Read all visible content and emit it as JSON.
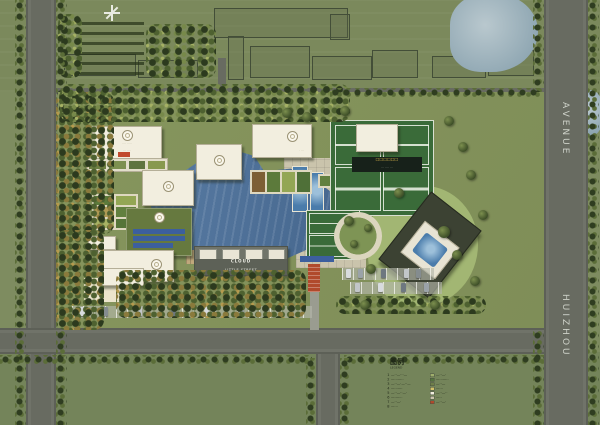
{
  "roads": {
    "avenue_top": "AVENUE",
    "avenue_bottom": "HUIZHOU"
  },
  "site": {
    "cloud_line1": "CLOUD",
    "cloud_line2": "LITTLE STREET",
    "court_line1": "□□□□□□",
    "court_line2": "··· ···· ···",
    "bldg_a_line1": "···· ·····",
    "bldg_a_line2": "··· ····",
    "bldg_c_note": "· ···",
    "strip1": "····· ····",
    "strip2": "···· ·····",
    "strip3": "·······",
    "plaza_strip": "····· ···"
  },
  "legend": {
    "title": "图例",
    "subtitle": "LEGEND",
    "left_items": [
      {
        "no": "1",
        "text": "—··—···—"
      },
      {
        "no": "2",
        "text": "—···—··"
      },
      {
        "no": "3",
        "text": "—··—·—··—"
      },
      {
        "no": "4",
        "text": "—···—·"
      },
      {
        "no": "5",
        "text": "—··—··—·"
      },
      {
        "no": "6",
        "text": "—·—···"
      },
      {
        "no": "7",
        "text": "—··—·"
      },
      {
        "no": "8",
        "text": "—···"
      }
    ],
    "right_items": [
      {
        "color": "#9fae6c",
        "text": "—··—·"
      },
      {
        "color": "#55743f",
        "text": "—···—··"
      },
      {
        "color": "#6f7f4a",
        "text": "—··—"
      },
      {
        "color": "#d3c169",
        "text": "—···"
      },
      {
        "color": "#f2eedf",
        "text": "—··—··"
      },
      {
        "color": "#c9c3ab",
        "text": "—··"
      },
      {
        "color": "#b04a2c",
        "text": "—··—·"
      }
    ]
  },
  "colors": {
    "lake": "#4f74a0",
    "field": "#7e8c60",
    "road": "#686b61",
    "court": "#3a6b39",
    "accent_red": "#b04a2c"
  }
}
